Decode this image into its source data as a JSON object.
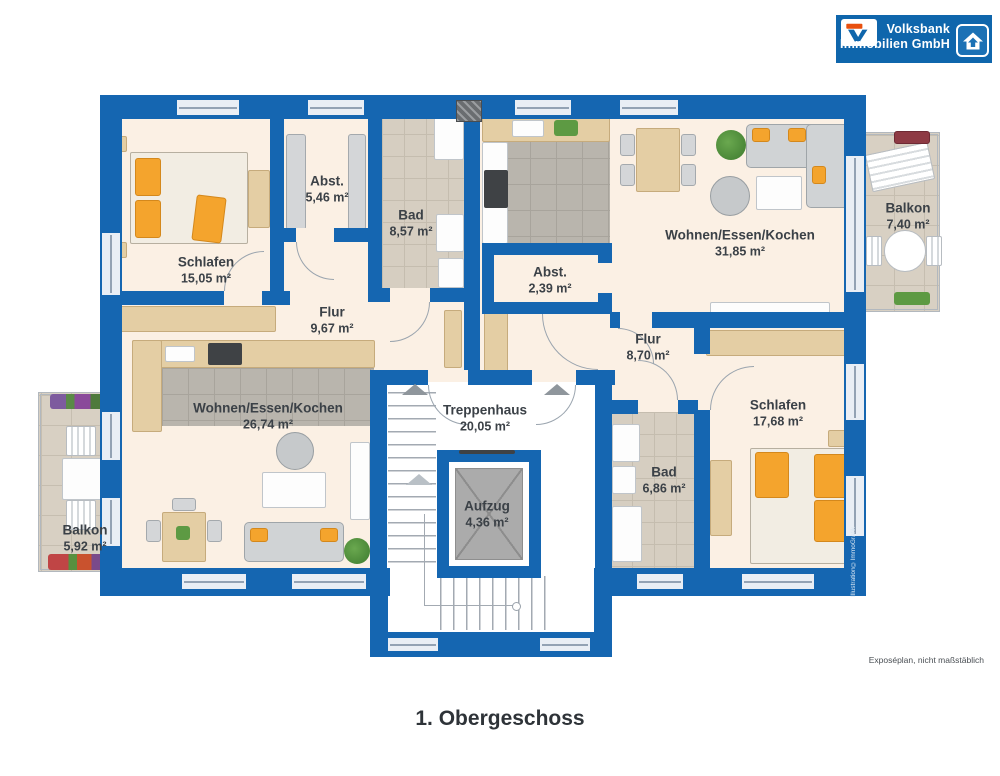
{
  "logo": {
    "line1": "Volksbank",
    "line2": "Immobilien GmbH"
  },
  "title": "1. Obergeschoss",
  "footnote": "Exposéplan, nicht maßstäblich",
  "credit": "Illustration©ImmoGrafik",
  "colors": {
    "wall": "#1566b1",
    "floor": "#fbf0e4",
    "brand_blue": "#0f66ac",
    "accent_orange": "#f4a42d",
    "label_text": "#3b4147"
  },
  "rooms": [
    {
      "id": "schlafen-left",
      "name": "Schlafen",
      "area": "15,05 m²"
    },
    {
      "id": "abstellraum-left",
      "name": "Abst.",
      "area": "5,46 m²"
    },
    {
      "id": "bad-left",
      "name": "Bad",
      "area": "8,57 m²"
    },
    {
      "id": "flur-left",
      "name": "Flur",
      "area": "9,67 m²"
    },
    {
      "id": "wohnen-essen-kochen-left",
      "name": "Wohnen/Essen/Kochen",
      "area": "26,74 m²"
    },
    {
      "id": "balkon-left",
      "name": "Balkon",
      "area": "5,92 m²"
    },
    {
      "id": "wohnen-essen-kochen-right",
      "name": "Wohnen/Essen/Kochen",
      "area": "31,85 m²"
    },
    {
      "id": "abstellraum-right",
      "name": "Abst.",
      "area": "2,39 m²"
    },
    {
      "id": "flur-right",
      "name": "Flur",
      "area": "8,70 m²"
    },
    {
      "id": "schlafen-right",
      "name": "Schlafen",
      "area": "17,68 m²"
    },
    {
      "id": "bad-right",
      "name": "Bad",
      "area": "6,86 m²"
    },
    {
      "id": "balkon-right",
      "name": "Balkon",
      "area": "7,40 m²"
    },
    {
      "id": "treppenhaus",
      "name": "Treppenhaus",
      "area": "20,05 m²"
    },
    {
      "id": "aufzug",
      "name": "Aufzug",
      "area": "4,36 m²"
    }
  ]
}
